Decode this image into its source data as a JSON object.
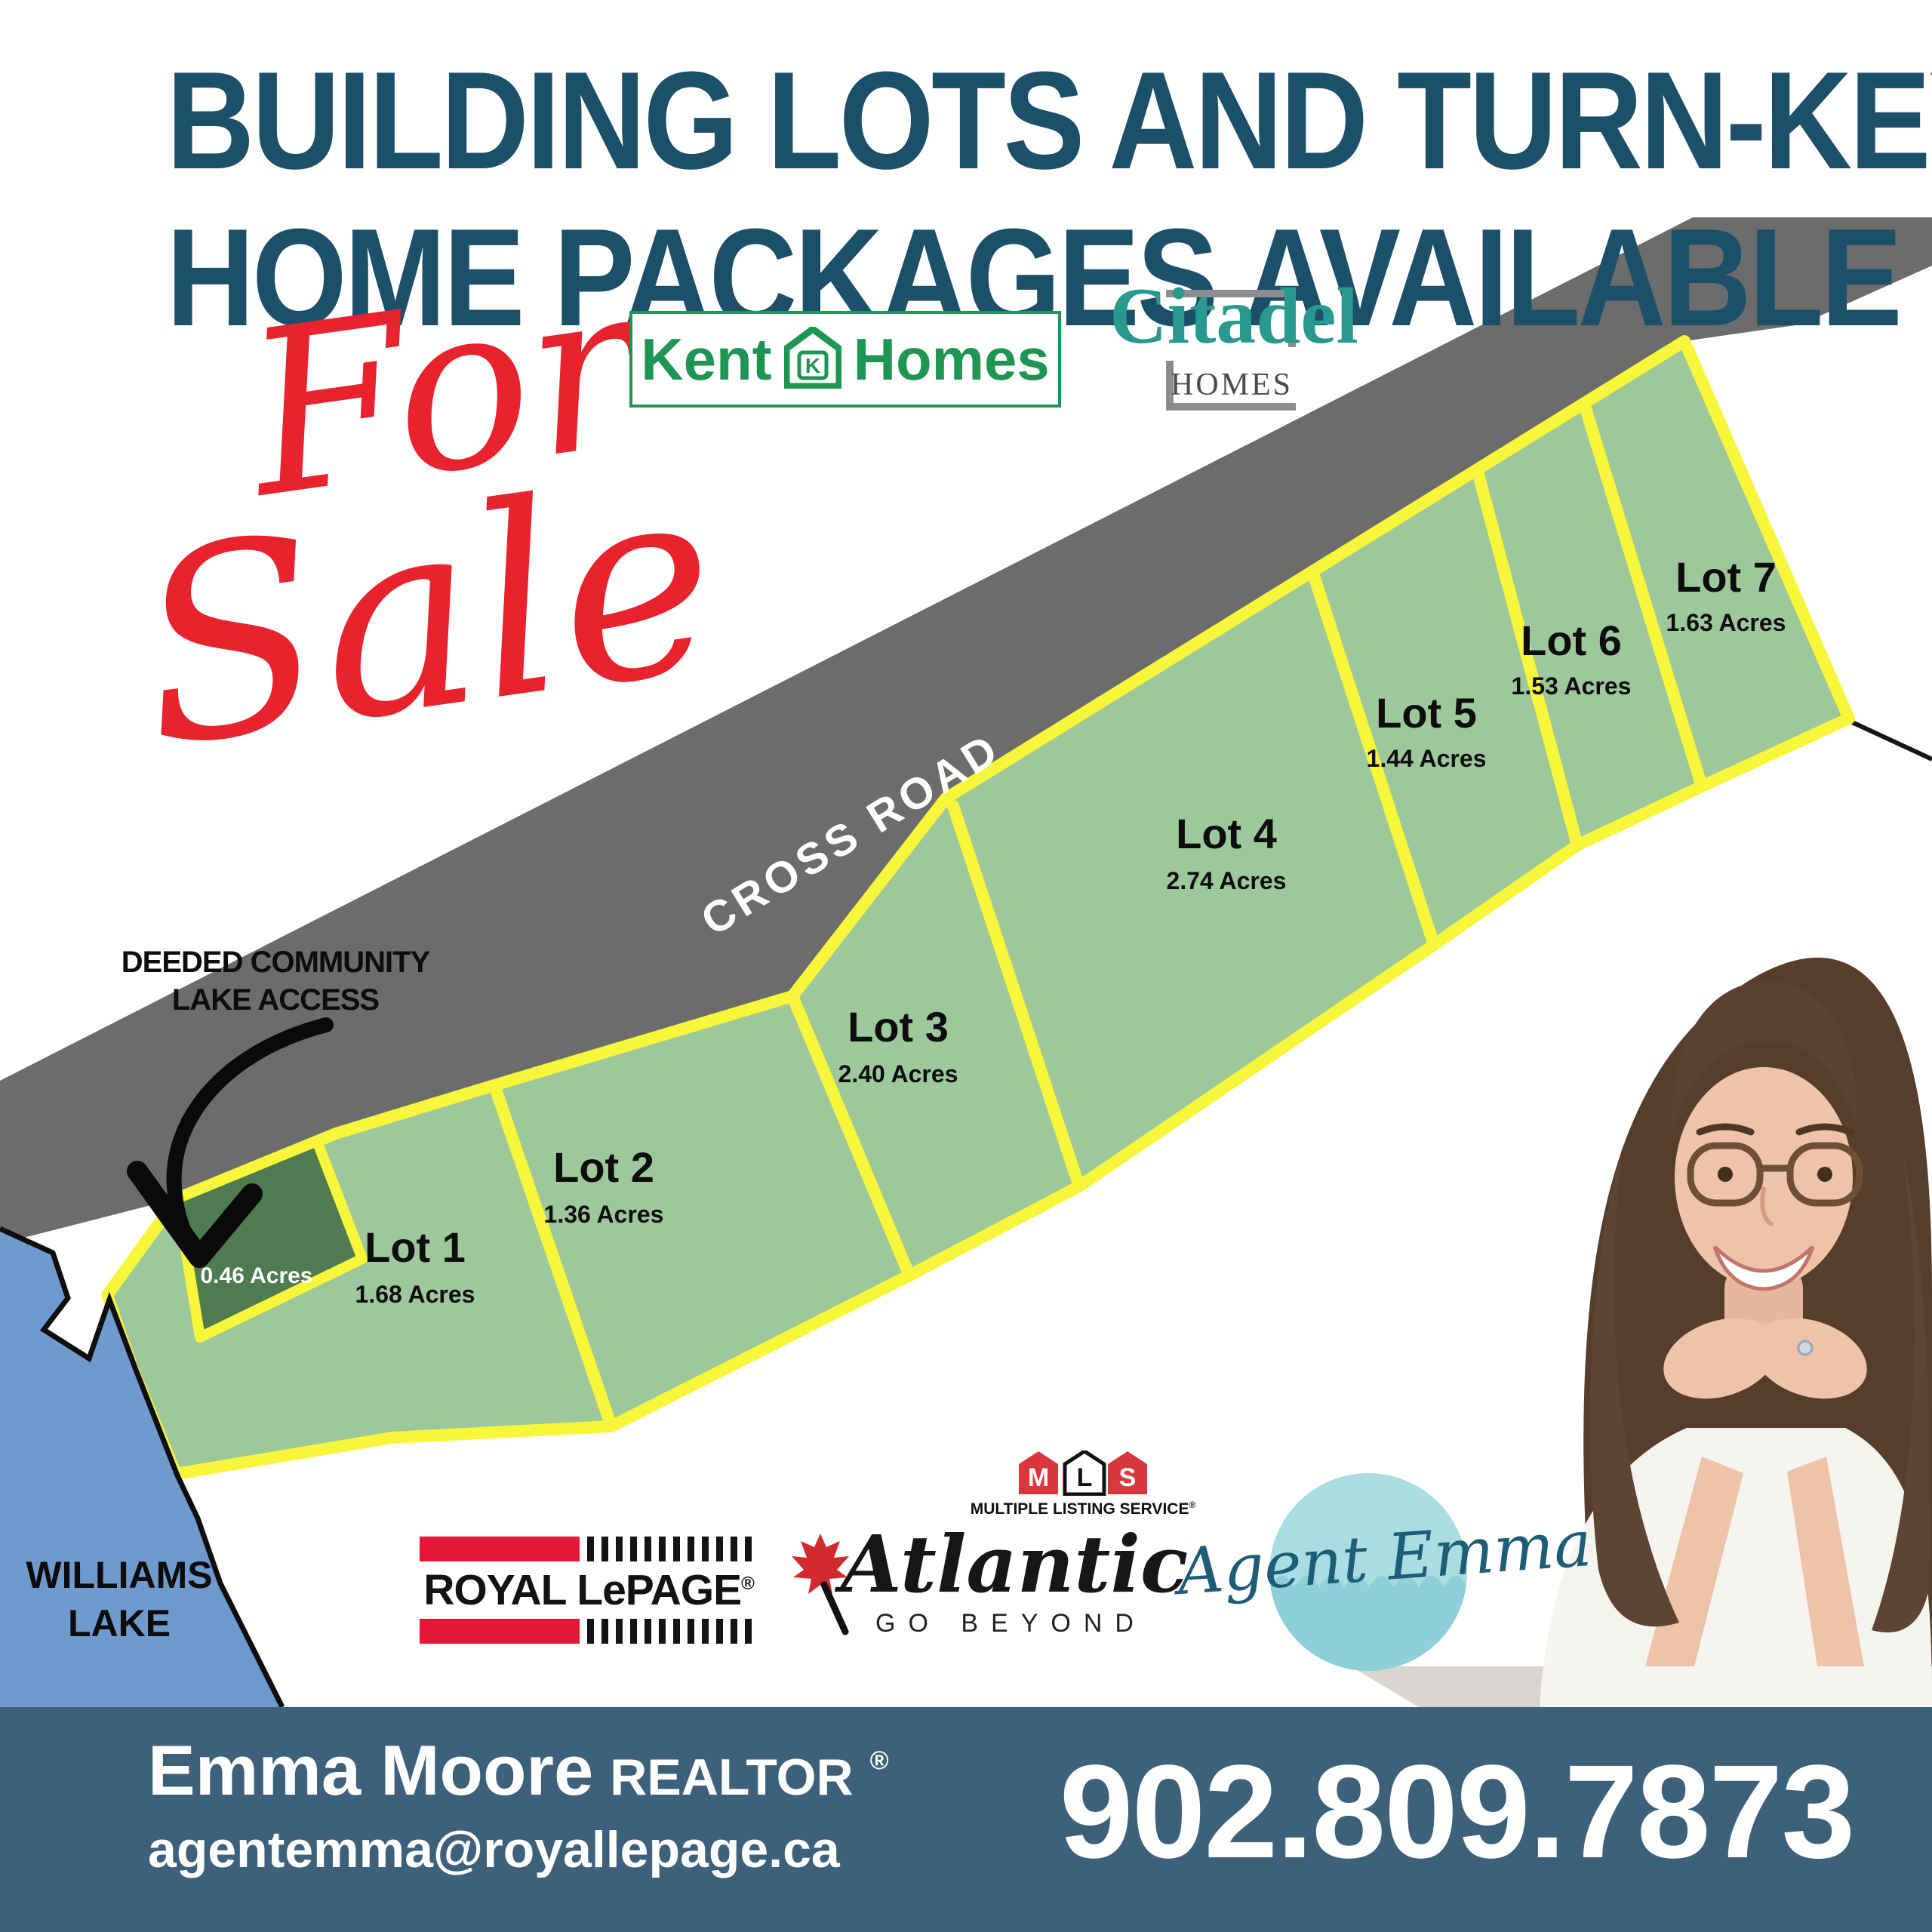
{
  "poster": {
    "title_line1": "BUILDING LOTS AND TURN-KEY",
    "title_line2": "HOME PACKAGES AVAILABLE",
    "for_sale_word1": "For",
    "for_sale_word2": "Sale"
  },
  "builder_logos": {
    "kent_homes": {
      "word1": "Kent",
      "word2": "Homes",
      "icon_letter": "K"
    },
    "citadel": {
      "name": "Citadel",
      "subtitle": "HOMES"
    }
  },
  "map": {
    "road_label": "CROSS ROAD",
    "access_note_line1": "DEEDED COMMUNITY",
    "access_note_line2": "LAKE ACCESS",
    "access_lot_area": "0.46 Acres",
    "lake_name_line1": "WILLIAMS",
    "lake_name_line2": "LAKE",
    "lots": [
      {
        "name": "Lot 1",
        "area": "1.68 Acres"
      },
      {
        "name": "Lot 2",
        "area": "1.36 Acres"
      },
      {
        "name": "Lot 3",
        "area": "2.40 Acres"
      },
      {
        "name": "Lot 4",
        "area": "2.74 Acres"
      },
      {
        "name": "Lot 5",
        "area": "1.44 Acres"
      },
      {
        "name": "Lot 6",
        "area": "1.53 Acres"
      },
      {
        "name": "Lot 7",
        "area": "1.63 Acres"
      }
    ]
  },
  "brand_logos": {
    "mls": {
      "letter_m": "M",
      "letter_l": "L",
      "letter_s": "S",
      "caption": "MULTIPLE LISTING SERVICE",
      "registered": "®"
    },
    "royal_lepage": {
      "name": "ROYAL LePAGE",
      "registered": "®"
    },
    "atlantic": {
      "name": "Atlantic",
      "tagline": "GO BEYOND"
    },
    "agent_emma": {
      "script_text": "Agent Emma"
    }
  },
  "footer": {
    "agent_name": "Emma Moore",
    "agent_title": "REALTOR",
    "registered": "®",
    "email": "agentemma@royallepage.ca",
    "phone": "902.809.7873"
  },
  "colors": {
    "title_teal": "#1b4f6a",
    "sale_red": "#e8232e",
    "road_gray": "#6b6c6b",
    "lot_green": "#9cc89b",
    "access_lot_green": "#4e7b4f",
    "border_yellow": "#f8f63b",
    "lake_blue": "#6f9ace",
    "footer_blue": "#3d617b",
    "kent_green": "#1f9553",
    "citadel_teal": "#27998f",
    "mls_red": "#d9373d",
    "lepage_red": "#e31837",
    "agent_emma_teal": "#aadde2"
  }
}
